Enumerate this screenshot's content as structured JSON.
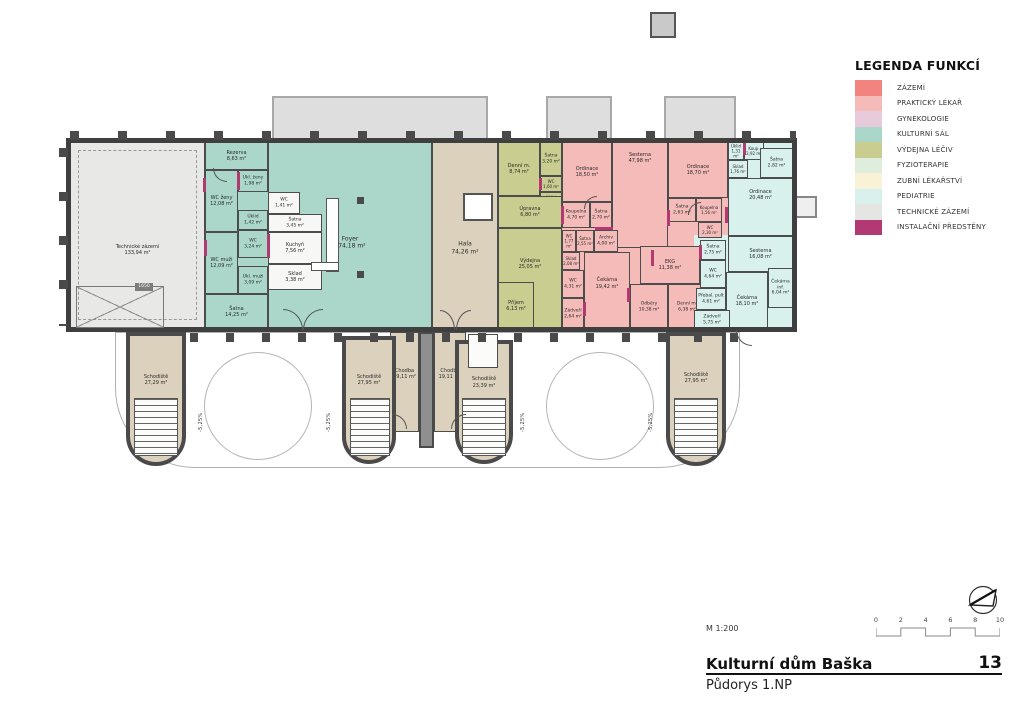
{
  "legend": {
    "title": "LEGENDA FUNKCÍ",
    "items": [
      {
        "key": "zazemi",
        "label": "ZÁZEMÍ",
        "color": "#F2837E"
      },
      {
        "key": "prakticky_lekar",
        "label": "PRAKTICKÝ LÉKAŘ",
        "color": "#F5BBB9"
      },
      {
        "key": "gynekologie",
        "label": "GYNEKOLOGIE",
        "color": "#E7CBDD"
      },
      {
        "key": "kulturni_sal",
        "label": "KULTURNÍ SÁL",
        "color": "#ABD7CB"
      },
      {
        "key": "vydejna_leciv",
        "label": "VÝDEJNA LÉČIV",
        "color": "#C9CE90"
      },
      {
        "key": "fyzioterapie",
        "label": "FYZIOTERAPIE",
        "color": "#DFEEDC"
      },
      {
        "key": "zubni_lekarstvi",
        "label": "ZUBNÍ LÉKAŘSTVÍ",
        "color": "#FAF2D7"
      },
      {
        "key": "pediatrie",
        "label": "PEDIATRIE",
        "color": "#D8F1EC"
      },
      {
        "key": "technicke_zazemi",
        "label": "TECHNICKÉ ZÁZEMÍ",
        "color": "#E5E5E4"
      },
      {
        "key": "instalacni_predsteny",
        "label": "INSTALAČNÍ PŘEDSTĚNY",
        "color": "#B23A73"
      }
    ]
  },
  "plan": {
    "circulation_color": "#DCD1BC",
    "wall_color": "#4A4A4A",
    "ramp_label": "-5,25%",
    "door_width_label": "1650",
    "rooms": [
      {
        "id": "technicke-zazemi",
        "name": "Technické zázemí",
        "area": "133,94 m²",
        "zone": "technicke_zazemi"
      },
      {
        "id": "rezerva",
        "name": "Rezerva",
        "area": "8,63 m²",
        "zone": "kulturni_sal"
      },
      {
        "id": "wc-zeny",
        "name": "WC ženy",
        "area": "12,08 m²",
        "zone": "kulturni_sal"
      },
      {
        "id": "ukl-zeny",
        "name": "Úkl. ženy",
        "area": "1,98 m²",
        "zone": "kulturni_sal"
      },
      {
        "id": "uklid-142",
        "name": "Úklid",
        "area": "1,42 m²",
        "zone": "kulturni_sal"
      },
      {
        "id": "wc-324",
        "name": "WC",
        "area": "3,24 m²",
        "zone": "kulturni_sal"
      },
      {
        "id": "wc-muzi",
        "name": "WC muži",
        "area": "12,09 m²",
        "zone": "kulturni_sal"
      },
      {
        "id": "ukl-muzi",
        "name": "Úkl. muži",
        "area": "3,09 m²",
        "zone": "kulturni_sal"
      },
      {
        "id": "satna-1425",
        "name": "Šatna",
        "area": "14,25 m²",
        "zone": "kulturni_sal"
      },
      {
        "id": "foyer",
        "name": "Foyer",
        "area": "174,18 m²",
        "zone": "kulturni_sal"
      },
      {
        "id": "wc-141",
        "name": "WC",
        "area": "1,41 m²",
        "zone": "kulturni_sal"
      },
      {
        "id": "satna-345",
        "name": "Šatna",
        "area": "3,45 m²",
        "zone": "kulturni_sal"
      },
      {
        "id": "kuchyn",
        "name": "Kuchyň",
        "area": "7,56 m²",
        "zone": "kulturni_sal"
      },
      {
        "id": "sklad-338",
        "name": "Sklad",
        "area": "3,38 m²",
        "zone": "kulturni_sal"
      },
      {
        "id": "hala",
        "name": "Hala",
        "area": "74,26 m²",
        "zone": "circulation"
      },
      {
        "id": "denni-874",
        "name": "Denní m.",
        "area": "8,74 m²",
        "zone": "vydejna_leciv"
      },
      {
        "id": "satna-320",
        "name": "Šatna",
        "area": "3,20 m²",
        "zone": "vydejna_leciv"
      },
      {
        "id": "wc-160",
        "name": "WC",
        "area": "1,60 m²",
        "zone": "vydejna_leciv"
      },
      {
        "id": "uklid-230",
        "name": "Úklid",
        "area": "2,30 m²",
        "zone": "vydejna_leciv"
      },
      {
        "id": "upravna",
        "name": "Úpravna",
        "area": "6,80 m²",
        "zone": "vydejna_leciv"
      },
      {
        "id": "vydejna",
        "name": "Výdejna",
        "area": "25,05 m²",
        "zone": "vydejna_leciv"
      },
      {
        "id": "prijem",
        "name": "Příjem",
        "area": "6,13 m²",
        "zone": "vydejna_leciv"
      },
      {
        "id": "ordinace-1850",
        "name": "Ordinace",
        "area": "18,50 m²",
        "zone": "prakticky_lekar"
      },
      {
        "id": "sesterna-4798",
        "name": "Sesterna",
        "area": "47,98 m²",
        "zone": "prakticky_lekar"
      },
      {
        "id": "ordinace-1870",
        "name": "Ordinace",
        "area": "18,70 m²",
        "zone": "prakticky_lekar"
      },
      {
        "id": "koupelna-470",
        "name": "Koupelna",
        "area": "4,70 m²",
        "zone": "prakticky_lekar"
      },
      {
        "id": "satna-270",
        "name": "Šatna",
        "area": "2,70 m²",
        "zone": "prakticky_lekar"
      },
      {
        "id": "wc-177",
        "name": "WC",
        "area": "1,77 m²",
        "zone": "prakticky_lekar"
      },
      {
        "id": "satna-255",
        "name": "Šatna",
        "area": "2,55 m²",
        "zone": "prakticky_lekar"
      },
      {
        "id": "archiv-400",
        "name": "Archiv",
        "area": "4,00 m²",
        "zone": "prakticky_lekar"
      },
      {
        "id": "sklad-208",
        "name": "Sklad",
        "area": "2,08 m²",
        "zone": "prakticky_lekar"
      },
      {
        "id": "wc-431",
        "name": "WC",
        "area": "4,31 m²",
        "zone": "prakticky_lekar"
      },
      {
        "id": "zadveri-264",
        "name": "Zádveří",
        "area": "2,64 m²",
        "zone": "prakticky_lekar"
      },
      {
        "id": "cekarna-1942",
        "name": "Čekárna",
        "area": "19,42 m²",
        "zone": "prakticky_lekar"
      },
      {
        "id": "odbery",
        "name": "Odběry",
        "area": "10,38 m²",
        "zone": "prakticky_lekar"
      },
      {
        "id": "ekg",
        "name": "EKG",
        "area": "11,38 m²",
        "zone": "prakticky_lekar"
      },
      {
        "id": "denni-638",
        "name": "Denní m.",
        "area": "6,38 m²",
        "zone": "prakticky_lekar"
      },
      {
        "id": "satna-263",
        "name": "Šatna",
        "area": "2,63 m²",
        "zone": "prakticky_lekar"
      },
      {
        "id": "koupelna-156",
        "name": "Koupelna",
        "area": "1,56 m²",
        "zone": "prakticky_lekar"
      },
      {
        "id": "wc-230p",
        "name": "WC",
        "area": "2,30 m²",
        "zone": "prakticky_lekar"
      },
      {
        "id": "ordinace-2048",
        "name": "Ordinace",
        "area": "20,48 m²",
        "zone": "pediatrie"
      },
      {
        "id": "uklid-131",
        "name": "Úklid",
        "area": "1,31 m²",
        "zone": "pediatrie"
      },
      {
        "id": "koup-292",
        "name": "Koup.",
        "area": "2,92 m²",
        "zone": "pediatrie"
      },
      {
        "id": "sklad-176",
        "name": "Sklad",
        "area": "1,76 m²",
        "zone": "pediatrie"
      },
      {
        "id": "satna-282",
        "name": "Šatna",
        "area": "2,82 m²",
        "zone": "pediatrie"
      },
      {
        "id": "sesterna-1608",
        "name": "Sesterna",
        "area": "16,08 m²",
        "zone": "pediatrie"
      },
      {
        "id": "satna-275",
        "name": "Šatna",
        "area": "2,75 m²",
        "zone": "pediatrie"
      },
      {
        "id": "wc-464",
        "name": "WC",
        "area": "4,64 m²",
        "zone": "pediatrie"
      },
      {
        "id": "prebal",
        "name": "Přebal. pult",
        "area": "4,61 m²",
        "zone": "pediatrie"
      },
      {
        "id": "cekarna-1810",
        "name": "Čekárna",
        "area": "18,10 m²",
        "zone": "pediatrie"
      },
      {
        "id": "cekarna-inf",
        "name": "Čekárna inf.",
        "area": "6,04 m²",
        "zone": "pediatrie"
      },
      {
        "id": "zadveri-575",
        "name": "Zádveří",
        "area": "5,75 m²",
        "zone": "pediatrie"
      },
      {
        "id": "chodba-1",
        "name": "Chodba",
        "area": "19,11 m²",
        "zone": "circulation"
      },
      {
        "id": "chodba-2",
        "name": "Chodba",
        "area": "19,11 m²",
        "zone": "circulation"
      },
      {
        "id": "schodiste-1",
        "name": "Schodiště",
        "area": "27,29 m²",
        "zone": "circulation"
      },
      {
        "id": "schodiste-2",
        "name": "Schodiště",
        "area": "27,95 m²",
        "zone": "circulation"
      },
      {
        "id": "schodiste-3",
        "name": "Schodiště",
        "area": "23,39 m²",
        "zone": "circulation"
      },
      {
        "id": "schodiste-4",
        "name": "Schodiště",
        "area": "27,95 m²",
        "zone": "circulation"
      }
    ]
  },
  "titleblock": {
    "scale_label": "M 1:200",
    "scale_ticks": [
      "0",
      "2",
      "4",
      "6",
      "8",
      "10"
    ],
    "project_title": "Kulturní dům Baška",
    "sheet_number": "13",
    "drawing_title": "Půdorys 1.NP"
  }
}
